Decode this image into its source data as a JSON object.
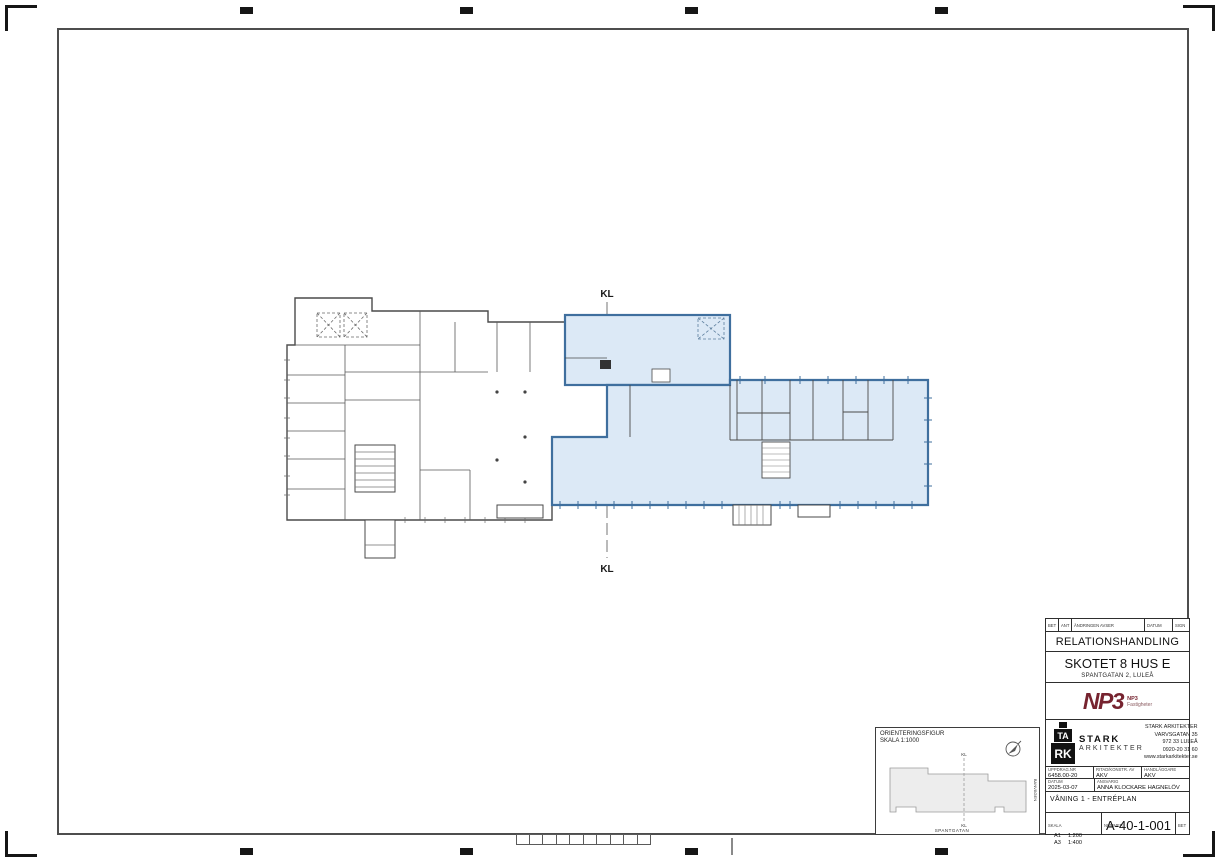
{
  "colors": {
    "highlight_fill": "#dce9f6",
    "highlight_border": "#3f6f9e",
    "wall": "#4a4a4a",
    "np3_brand": "#76232f"
  },
  "plan": {
    "kl_top": "KL",
    "kl_bottom": "KL"
  },
  "title_block": {
    "revision_header": {
      "bet": "BET",
      "ant": "ANT",
      "avser": "ÄNDRINGEN AVSER",
      "datum": "DATUM",
      "sign": "SIGN"
    },
    "document_type": "RELATIONSHANDLING",
    "project_name": "SKOTET 8 HUS E",
    "project_address": "SPANTGATAN 2, LULEÅ",
    "client": {
      "logo_text": "NP3",
      "sub_line1": "NP3",
      "sub_line2": "Fastigheter"
    },
    "architect": {
      "logo_block_mid": "TA",
      "logo_block_bottom": "RK",
      "logo_name": "STARK",
      "logo_sub": "ARKITEKTER",
      "address_lines": [
        "STARK ARKITEKTER",
        "VARVSGATAN 35",
        "972 33 LULEÅ",
        "0920-20 31 60",
        "www.starkarkitekter.se"
      ]
    },
    "fields": {
      "uppdrag_label": "UPPDRAG.NR",
      "uppdrag_value": "6458.00-20",
      "ritad_label": "RITAD/KONSTR. AV",
      "ritad_value": "AKV",
      "handlaggare_label": "HANDLÄGGARE",
      "handlaggare_value": "AKV",
      "datum_label": "DATUM",
      "datum_value": "2025-03-07",
      "ansvarig_label": "ANSVARIG",
      "ansvarig_value": "ANNA KLOCKARE HAGNELÖV"
    },
    "drawing_title": "VÅNING 1 - ENTRÉPLAN",
    "scale": {
      "label": "SKALA",
      "a1_label": "A1",
      "a1_value": "1:200",
      "a3_label": "A3",
      "a3_value": "1:400"
    },
    "number": {
      "label": "NUMMER",
      "value": "A-40-1-001"
    },
    "bet_label": "BET"
  },
  "orientation_figure": {
    "title": "ORIENTERINGSFIGUR",
    "scale": "SKALA 1:1000",
    "kl_top": "KL",
    "kl_bottom": "KL",
    "street_bottom": "SPANTGATAN",
    "street_right": "BANVÄGEN"
  }
}
